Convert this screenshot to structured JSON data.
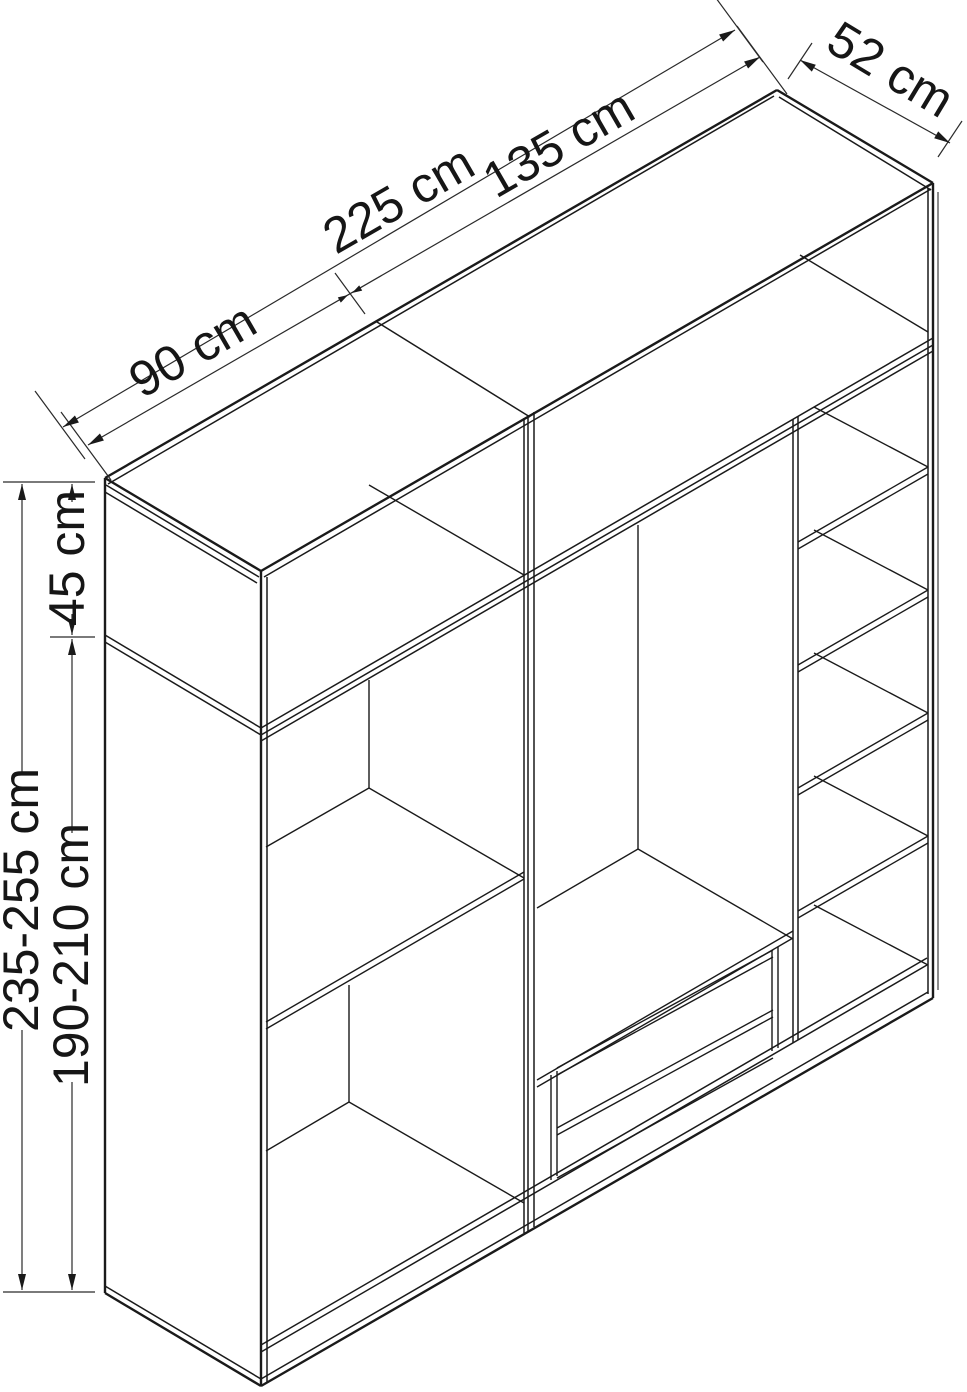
{
  "meta": {
    "figure": "Isometric technical line drawing of a two-module open wardrobe with dimension annotations",
    "background_color": "#ffffff",
    "line_color": "#1a1a1a"
  },
  "dims": {
    "total_width": "225 cm",
    "left_module_width": "90 cm",
    "right_module_width": "135 cm",
    "depth": "52 cm",
    "top_section_height": "45 cm",
    "total_height": "235-255 cm",
    "lower_section_height": "190-210 cm"
  },
  "structure": {
    "modules": [
      {
        "name": "left module",
        "width_label": "90 cm",
        "features": [
          "top cabinet",
          "middle shelf",
          "floor panel"
        ]
      },
      {
        "name": "right module",
        "width_label": "135 cm",
        "features": [
          "top cabinet",
          "tall compartment with 2 drawers",
          "narrow column with 4 shelves"
        ]
      }
    ],
    "drawer_count": 2,
    "right_column_shelf_count": 4
  }
}
